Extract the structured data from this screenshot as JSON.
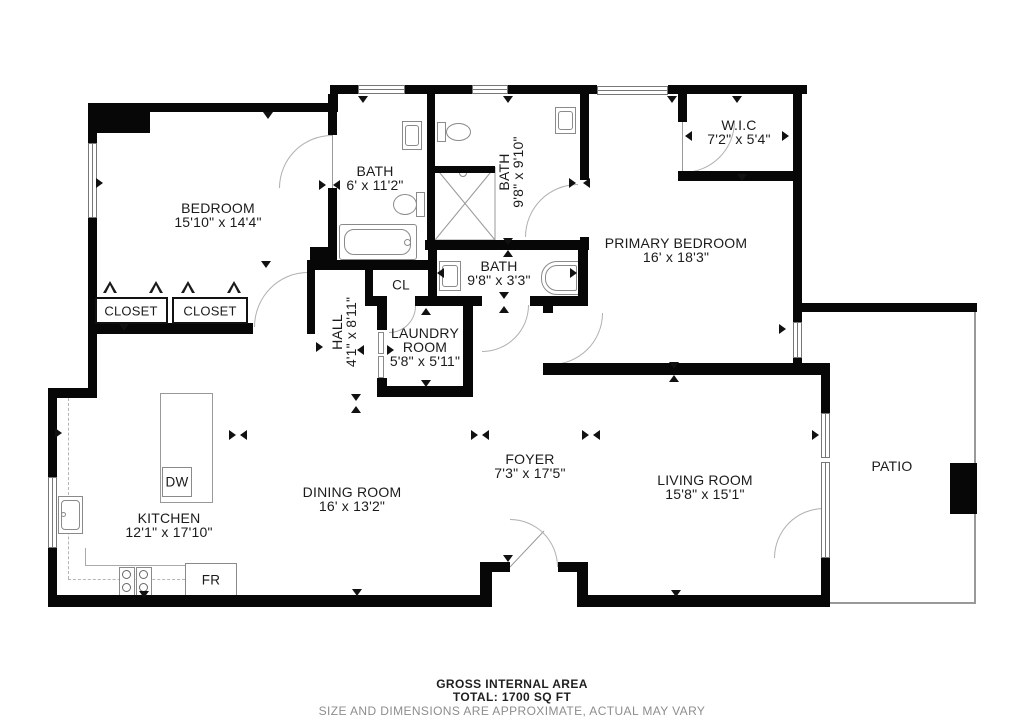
{
  "rooms": [
    {
      "id": "bedroom",
      "name": "BEDROOM",
      "dims": "15'10\" x 14'4\""
    },
    {
      "id": "bath1",
      "name": "BATH",
      "dims": "6' x 11'2\""
    },
    {
      "id": "bath2",
      "name": "BATH",
      "dims": "9'8\" x 9'10\""
    },
    {
      "id": "wic",
      "name": "W.I.C",
      "dims": "7'2\" x 5'4\""
    },
    {
      "id": "primary-bedroom",
      "name": "PRIMARY BEDROOM",
      "dims": "16' x 18'3\""
    },
    {
      "id": "bath3",
      "name": "BATH",
      "dims": "9'8\" x 3'3\""
    },
    {
      "id": "hall",
      "name": "HALL",
      "dims": "4'1\" x 8'11\""
    },
    {
      "id": "laundry",
      "name": "LAUNDRY ROOM",
      "dims": "5'8\" x 5'11\""
    },
    {
      "id": "kitchen",
      "name": "KITCHEN",
      "dims": "12'1\" x 17'10\""
    },
    {
      "id": "dining",
      "name": "DINING ROOM",
      "dims": "16' x 13'2\""
    },
    {
      "id": "foyer",
      "name": "FOYER",
      "dims": "7'3\" x 17'5\""
    },
    {
      "id": "living",
      "name": "LIVING ROOM",
      "dims": "15'8\" x 15'1\""
    },
    {
      "id": "patio",
      "name": "PATIO",
      "dims": ""
    }
  ],
  "labels": {
    "closet1": "CLOSET",
    "closet2": "CLOSET",
    "cl": "CL",
    "dw": "DW",
    "fr": "FR"
  },
  "footer": {
    "line1": "GROSS INTERNAL AREA",
    "line2": "TOTAL: 1700 SQ FT",
    "line3": "SIZE AND DIMENSIONS ARE APPROXIMATE, ACTUAL MAY VARY"
  }
}
